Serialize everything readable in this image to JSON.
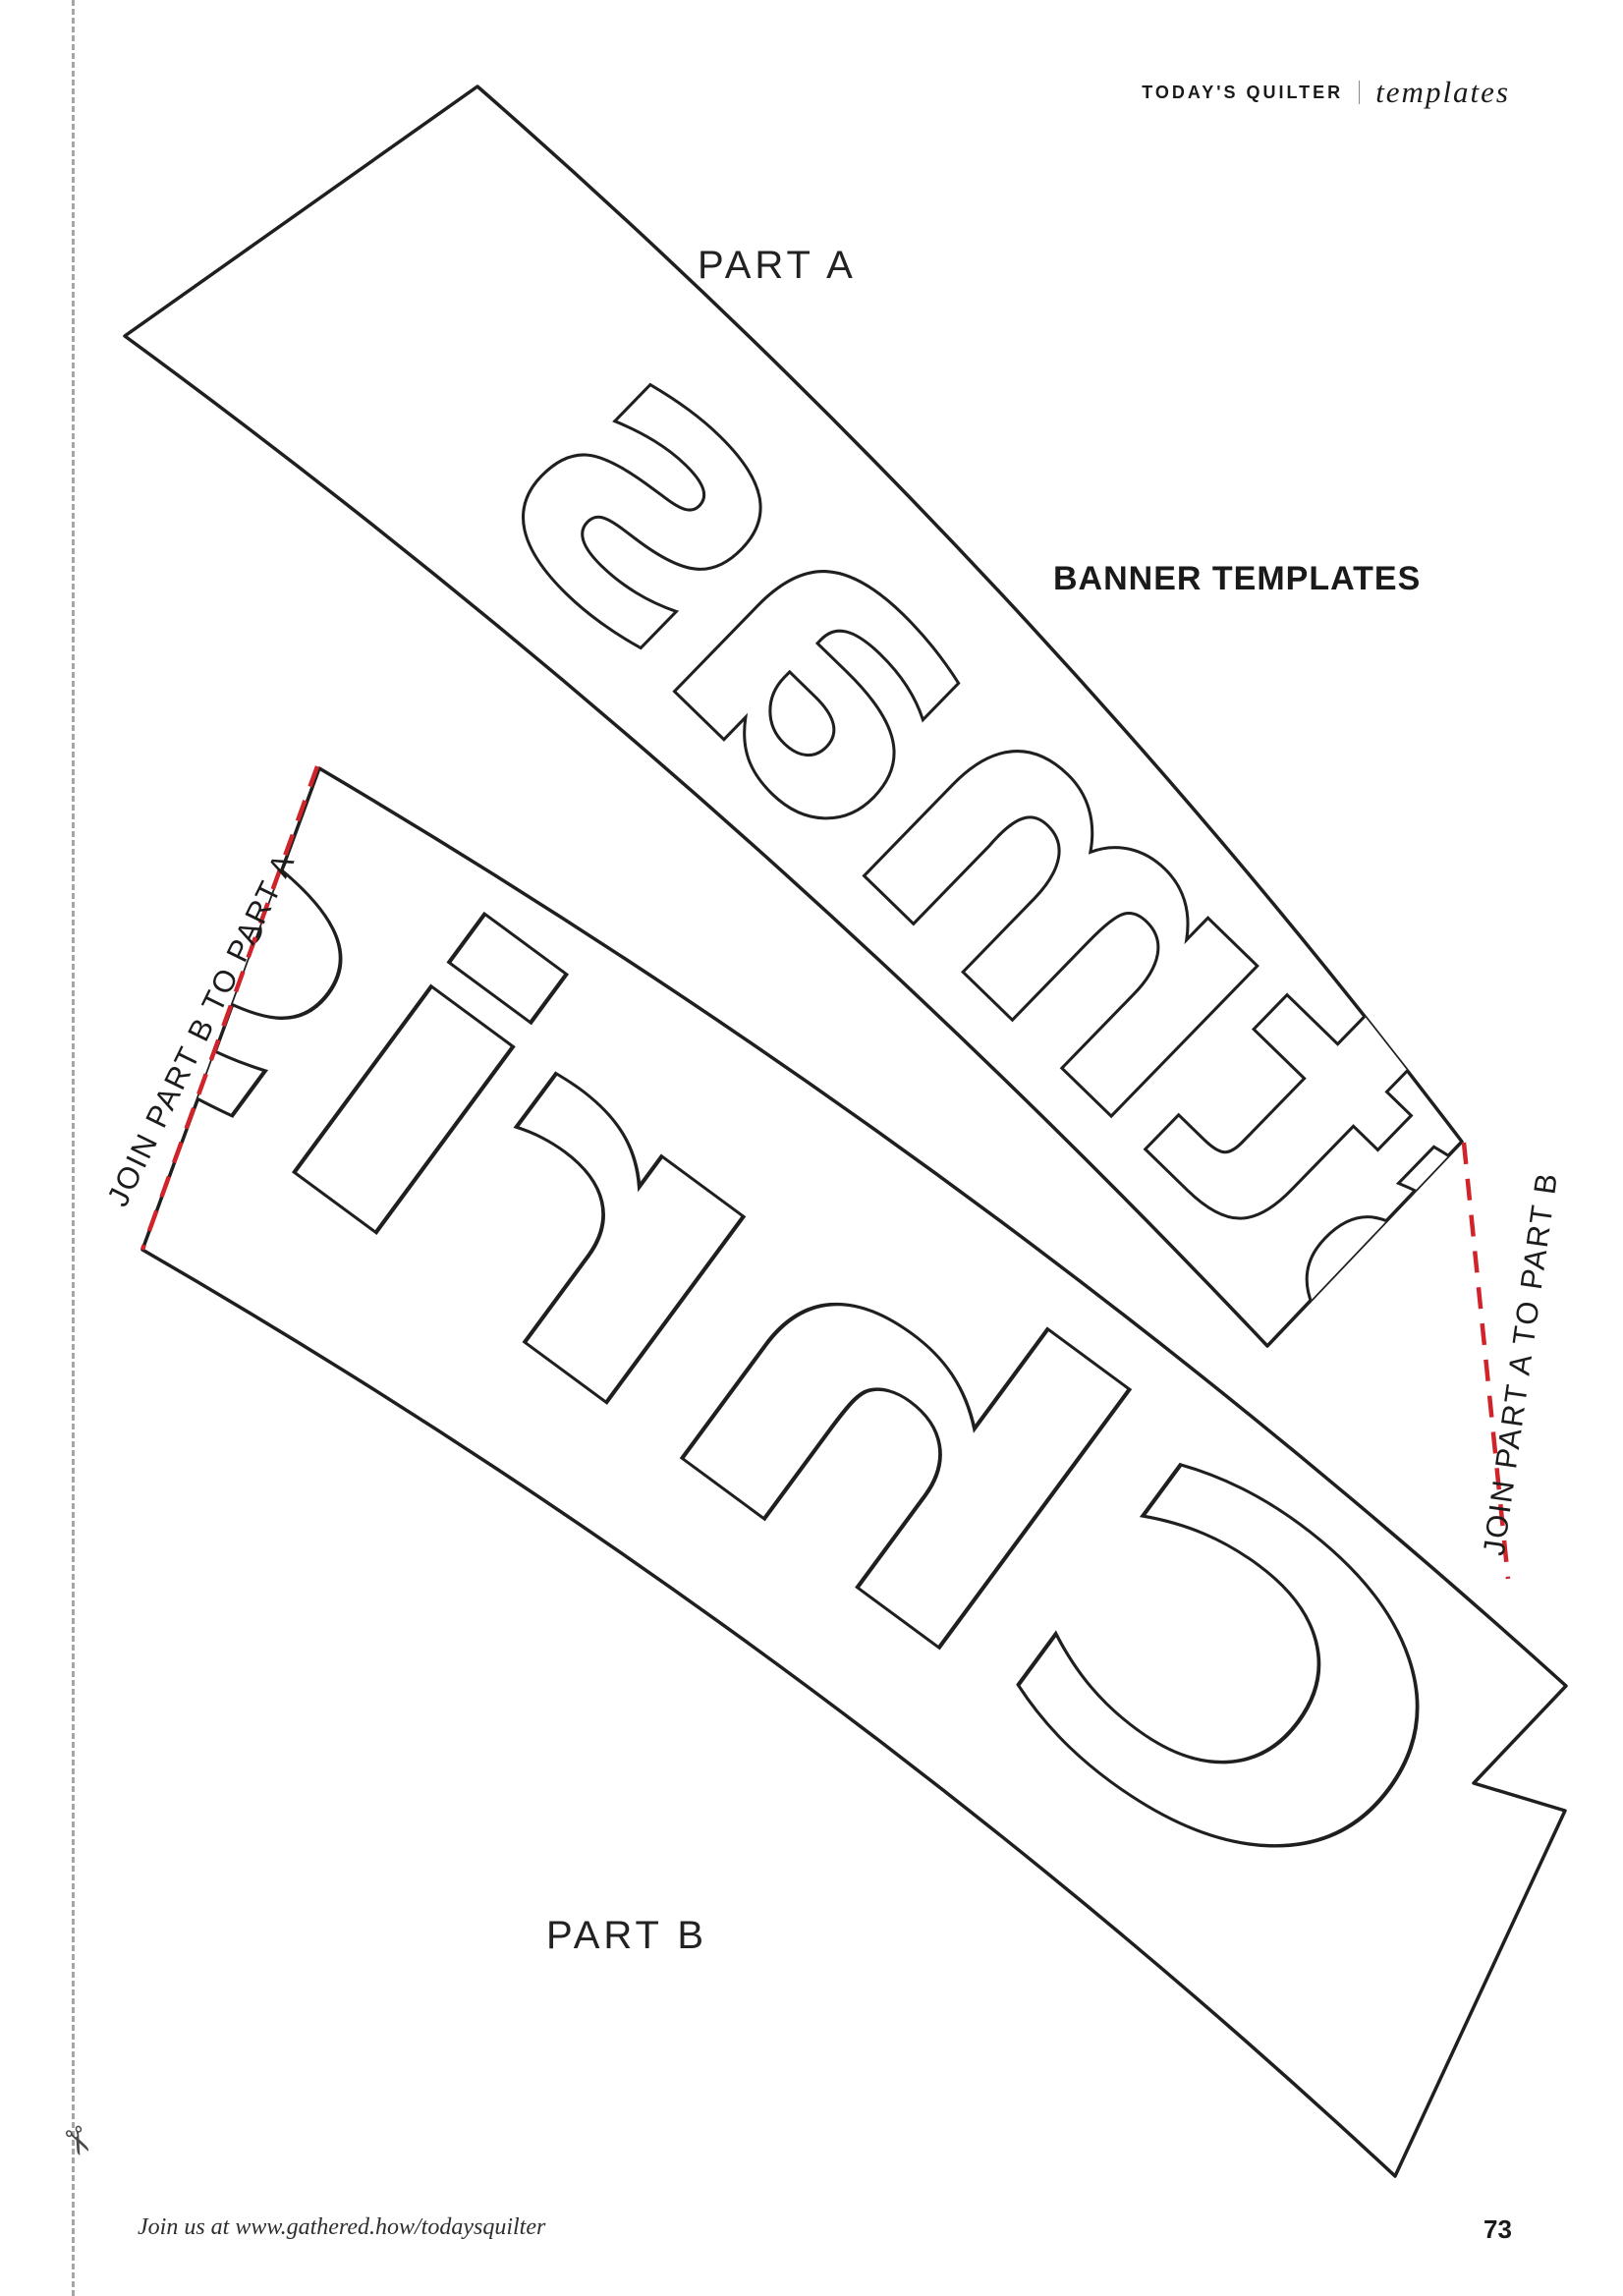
{
  "header": {
    "magazine": "TODAY'S QUILTER",
    "section": "templates"
  },
  "labels": {
    "part_a": "PART A",
    "part_b": "PART B",
    "banner_templates": "BANNER TEMPLATES",
    "join_left": "JOIN PART B TO PART A",
    "join_right": "JOIN PART A TO PART B"
  },
  "templates": {
    "part_a_letters": "stmas",
    "part_b_letters": "Chris"
  },
  "footer": {
    "join_us": "Join us at www.gathered.how/todaysquilter",
    "page_number": "73"
  },
  "icons": {
    "scissors": "✂"
  },
  "colors": {
    "outline": "#1f1f1f",
    "join_line_red": "#d1232a",
    "cut_line_gray": "#a6a6a6"
  }
}
